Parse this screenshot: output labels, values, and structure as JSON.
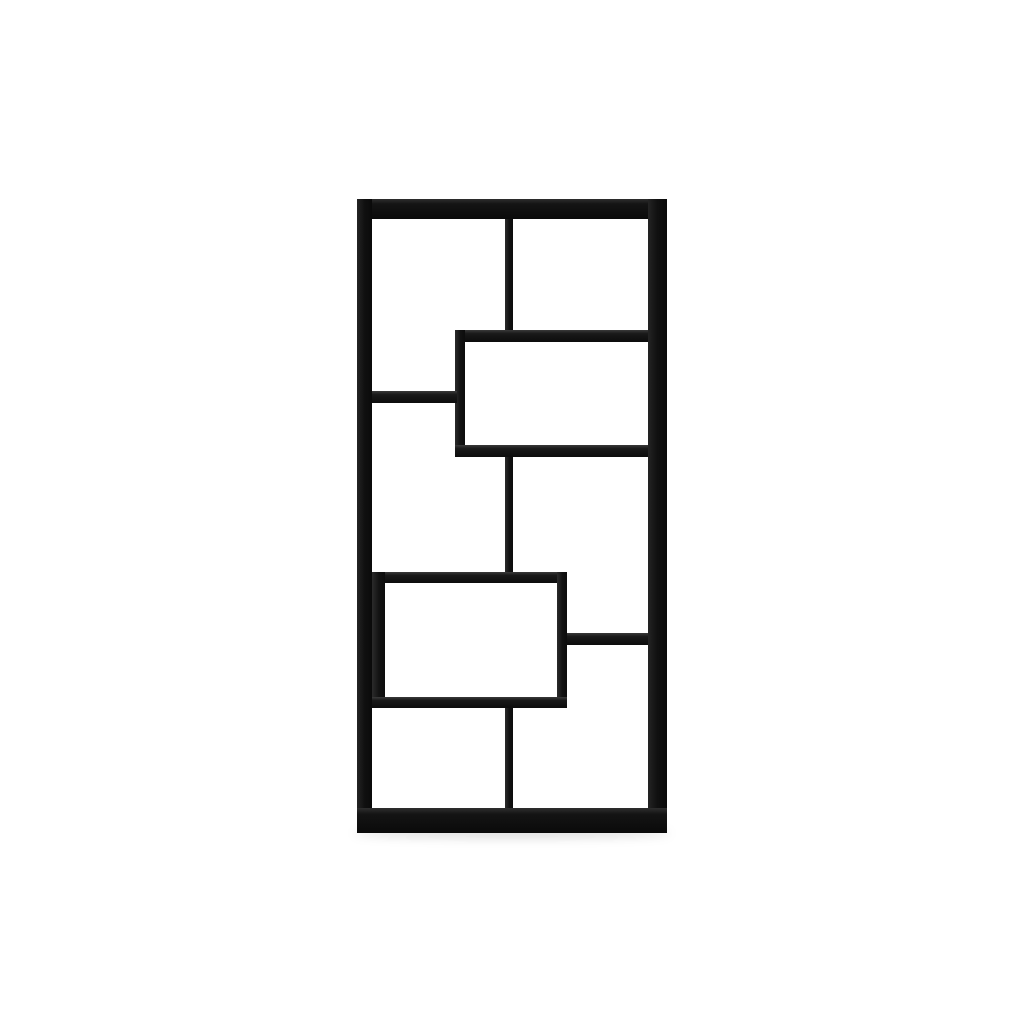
{
  "scene": {
    "type": "product-photo",
    "subject": "black geometric staggered-cube bookcase, front view, centered on plain white background",
    "background_color": "#ffffff",
    "unit_color": "#0d0d0d",
    "highlight_color": "#333333",
    "floor_shadow_color": "rgba(0,0,0,0.14)"
  },
  "bookcase": {
    "x": 357,
    "y": 199,
    "width": 310,
    "height": 634,
    "compartment_count": 8,
    "shadow": {
      "x": -3,
      "y": 629,
      "w": 316,
      "h": 10
    },
    "bars": [
      {
        "name": "frame-top-rail",
        "x": 0,
        "y": 0,
        "w": 310,
        "h": 20,
        "orientation": "h",
        "frame": true
      },
      {
        "name": "frame-left-side",
        "x": 0,
        "y": 0,
        "w": 15,
        "h": 634,
        "orientation": "v",
        "frame": true
      },
      {
        "name": "frame-right-side",
        "x": 291,
        "y": 0,
        "w": 19,
        "h": 634,
        "orientation": "v",
        "frame": true
      },
      {
        "name": "frame-bottom-rail",
        "x": 0,
        "y": 609,
        "w": 310,
        "h": 25,
        "orientation": "h",
        "frame": true
      },
      {
        "name": "top-center-divider",
        "x": 148,
        "y": 20,
        "w": 8,
        "h": 112,
        "orientation": "v",
        "frame": false
      },
      {
        "name": "upper-box-top-shelf",
        "x": 98,
        "y": 131,
        "w": 193,
        "h": 12,
        "orientation": "h",
        "frame": false
      },
      {
        "name": "upper-box-left-wall",
        "x": 98,
        "y": 131,
        "w": 10,
        "h": 127,
        "orientation": "v",
        "frame": false
      },
      {
        "name": "upper-box-bottom-shelf",
        "x": 98,
        "y": 246,
        "w": 193,
        "h": 12,
        "orientation": "h",
        "frame": false
      },
      {
        "name": "upper-left-shelf",
        "x": 15,
        "y": 192,
        "w": 85,
        "h": 12,
        "orientation": "h",
        "frame": false
      },
      {
        "name": "middle-center-divider",
        "x": 148,
        "y": 258,
        "w": 8,
        "h": 115,
        "orientation": "v",
        "frame": false
      },
      {
        "name": "lower-box-top-shelf",
        "x": 15,
        "y": 373,
        "w": 195,
        "h": 11,
        "orientation": "h",
        "frame": false
      },
      {
        "name": "lower-box-left-wall",
        "x": 15,
        "y": 373,
        "w": 13,
        "h": 136,
        "orientation": "v",
        "frame": false
      },
      {
        "name": "lower-box-right-wall",
        "x": 200,
        "y": 373,
        "w": 10,
        "h": 136,
        "orientation": "v",
        "frame": false
      },
      {
        "name": "lower-box-bottom-shelf",
        "x": 15,
        "y": 498,
        "w": 195,
        "h": 11,
        "orientation": "h",
        "frame": false
      },
      {
        "name": "lower-right-shelf",
        "x": 210,
        "y": 434,
        "w": 81,
        "h": 12,
        "orientation": "h",
        "frame": false
      },
      {
        "name": "bottom-center-divider",
        "x": 148,
        "y": 509,
        "w": 8,
        "h": 100,
        "orientation": "v",
        "frame": false
      }
    ]
  }
}
